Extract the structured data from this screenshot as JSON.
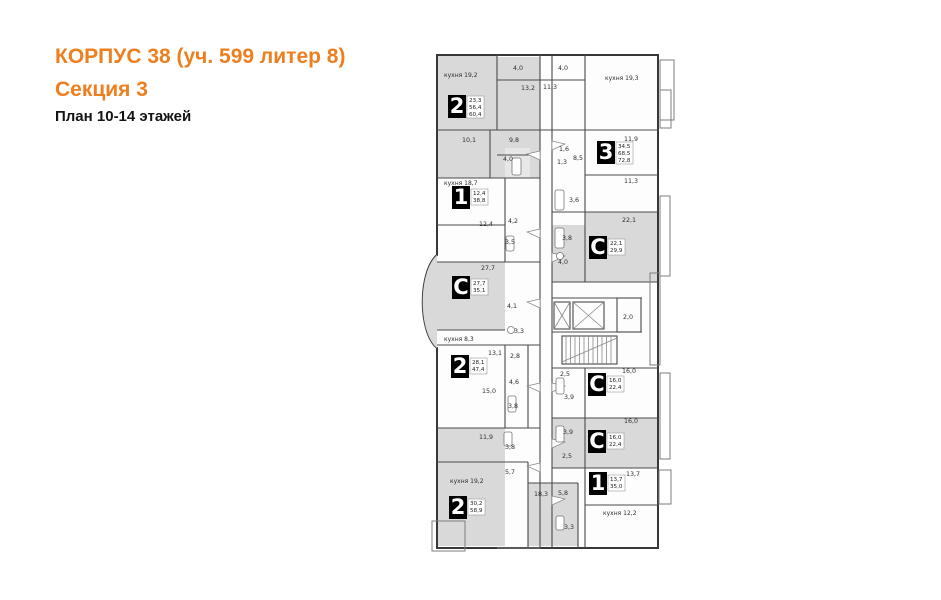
{
  "header": {
    "title": "КОРПУС 38 (уч. 599 литер 8)",
    "subtitle": "Секция 3",
    "caption": "План 10-14 этажей"
  },
  "colors": {
    "accent": "#ee7f1e",
    "room_fill": "#d9d9d9",
    "wall": "#4a4a4a"
  },
  "plan": {
    "units": [
      {
        "type": "2",
        "areas": [
          "23,3",
          "56,4",
          "60,4"
        ]
      },
      {
        "type": "3",
        "areas": [
          "34,5",
          "68,5",
          "72,8"
        ]
      },
      {
        "type": "1",
        "areas": [
          "12,4",
          "38,8"
        ]
      },
      {
        "type": "С",
        "areas": [
          "22,1",
          "29,9"
        ]
      },
      {
        "type": "С",
        "areas": [
          "27,7",
          "35,1"
        ]
      },
      {
        "type": "2",
        "areas": [
          "28,1",
          "47,4"
        ]
      },
      {
        "type": "С",
        "areas": [
          "16,0",
          "22,4"
        ]
      },
      {
        "type": "С",
        "areas": [
          "16,0",
          "22,4"
        ]
      },
      {
        "type": "1",
        "areas": [
          "13,7",
          "35,0"
        ]
      },
      {
        "type": "2",
        "areas": [
          "30,2",
          "58,9"
        ]
      }
    ],
    "room_labels": [
      {
        "text": "кухня 19,2"
      },
      {
        "text": "4,0"
      },
      {
        "text": "4,0"
      },
      {
        "text": "13,2"
      },
      {
        "text": "11,3"
      },
      {
        "text": "кухня 19,3"
      },
      {
        "text": "10,1"
      },
      {
        "text": "9,8"
      },
      {
        "text": "4,0"
      },
      {
        "text": "1,6"
      },
      {
        "text": "1,3"
      },
      {
        "text": "8,5"
      },
      {
        "text": "11,9"
      },
      {
        "text": "11,3"
      },
      {
        "text": "кухня 18,7"
      },
      {
        "text": "12,4"
      },
      {
        "text": "4,2"
      },
      {
        "text": "3,5"
      },
      {
        "text": "3,6"
      },
      {
        "text": "3,8"
      },
      {
        "text": "22,1"
      },
      {
        "text": "4,0"
      },
      {
        "text": "27,7"
      },
      {
        "text": "4,1"
      },
      {
        "text": "3,3"
      },
      {
        "text": "кухня 8,3"
      },
      {
        "text": "13,1"
      },
      {
        "text": "2,8"
      },
      {
        "text": "4,6"
      },
      {
        "text": "15,0"
      },
      {
        "text": "3,8"
      },
      {
        "text": "2,0"
      },
      {
        "text": "2,5"
      },
      {
        "text": "16,0"
      },
      {
        "text": "3,9"
      },
      {
        "text": "16,0"
      },
      {
        "text": "3,9"
      },
      {
        "text": "2,5"
      },
      {
        "text": "11,9"
      },
      {
        "text": "3,8"
      },
      {
        "text": "5,7"
      },
      {
        "text": "кухня 19,2"
      },
      {
        "text": "18,3"
      },
      {
        "text": "13,7"
      },
      {
        "text": "5,8"
      },
      {
        "text": "кухня 12,2"
      },
      {
        "text": "3,3"
      }
    ]
  }
}
